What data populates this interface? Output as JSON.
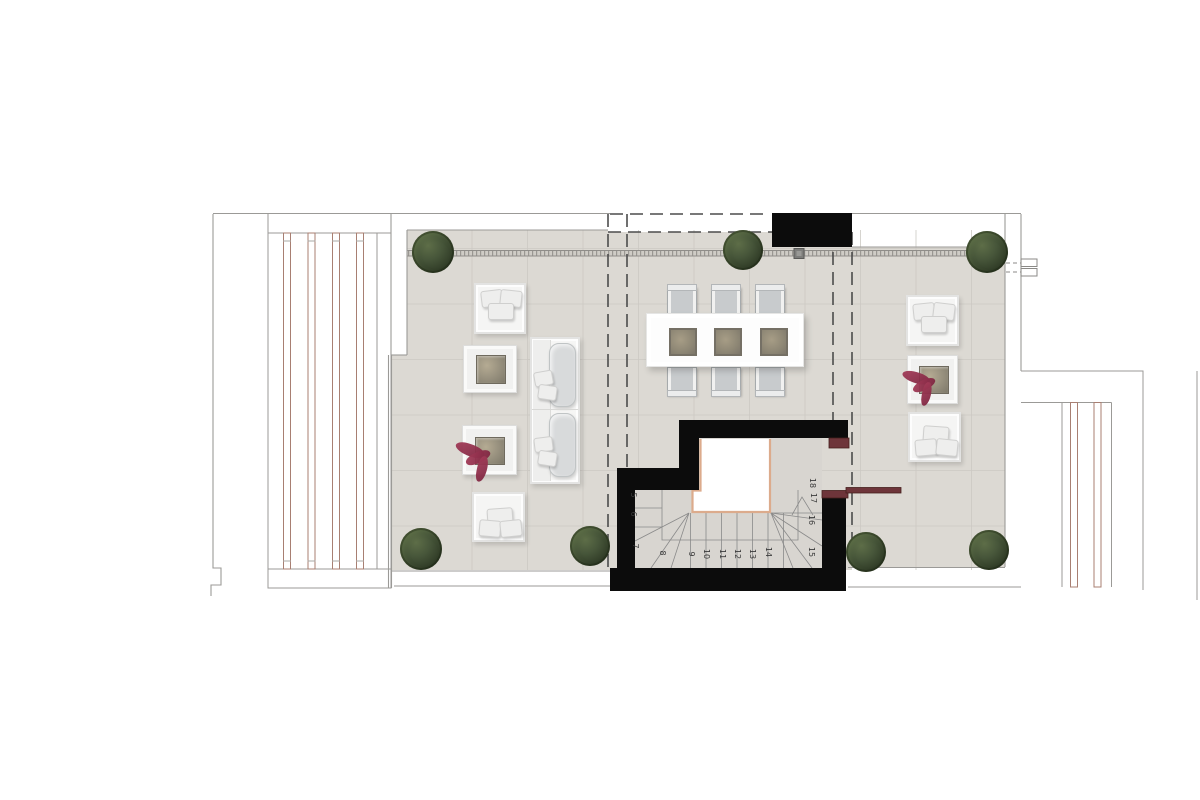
{
  "meta": {
    "type": "architectural floor plan",
    "subject": "roof terrace / solarium level plan with stair core"
  },
  "palette": {
    "background": "#ffffff",
    "tile": "#dcd9d3",
    "tile_grid": "#ccc9c3",
    "outline": "#9b9a97",
    "overhang_dash": "#4c4c4c",
    "wall_black": "#0c0c0c",
    "stair_void_trim": "#dcab8c",
    "handrail_maroon": "#6e353a",
    "pergola_slat": "#a87f72",
    "tree_green": "#333f29",
    "plant_red": "#a03a55"
  },
  "stairs": {
    "description": "winder stair, numbered treads",
    "steps": [
      {
        "n": "5",
        "x": 633,
        "y": 495
      },
      {
        "n": "6",
        "x": 633,
        "y": 514
      },
      {
        "n": "7",
        "x": 635,
        "y": 546
      },
      {
        "n": "8",
        "x": 662,
        "y": 553
      },
      {
        "n": "9",
        "x": 691,
        "y": 554
      },
      {
        "n": "10",
        "x": 706,
        "y": 554
      },
      {
        "n": "11",
        "x": 722,
        "y": 554
      },
      {
        "n": "12",
        "x": 737,
        "y": 554
      },
      {
        "n": "13",
        "x": 752,
        "y": 554
      },
      {
        "n": "14",
        "x": 768,
        "y": 552
      },
      {
        "n": "15",
        "x": 811,
        "y": 552
      },
      {
        "n": "16",
        "x": 811,
        "y": 520
      },
      {
        "n": "17",
        "x": 813,
        "y": 498
      },
      {
        "n": "18",
        "x": 812,
        "y": 483
      }
    ]
  }
}
